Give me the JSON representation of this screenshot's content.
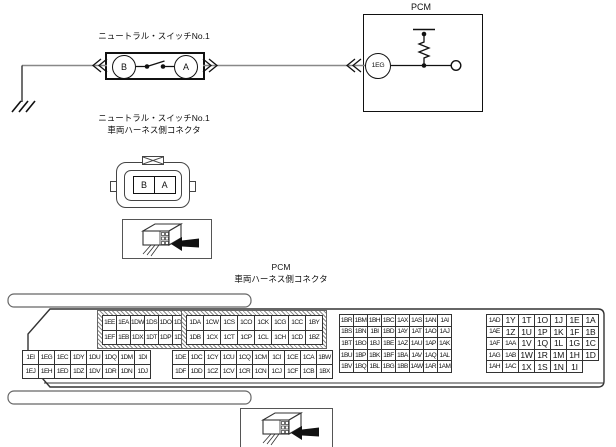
{
  "circuit": {
    "switch": {
      "label": "ニュートラル・スイッチNo.1",
      "terminal_left": "B",
      "terminal_right": "A"
    },
    "pcm": {
      "label": "PCM",
      "connector_pin": "1EG"
    }
  },
  "switch_connector": {
    "label_line1": "ニュートラル・スイッチNo.1",
    "label_line2": "車両ハーネス側コネクタ",
    "terminal_left": "B",
    "terminal_right": "A"
  },
  "pcm_connector": {
    "label_line1": "PCM",
    "label_line2": "車両ハーネス側コネクタ",
    "blocks": {
      "top_left": {
        "rows": [
          [
            "1EE",
            "1EA",
            "1DW",
            "1DS",
            "1DO",
            "1DK",
            "1DG"
          ],
          [
            "1EF",
            "1EB",
            "1DX",
            "1DT",
            "1DP",
            "1DL",
            "1DH"
          ]
        ]
      },
      "top_mid": {
        "rows": [
          [
            "1DA",
            "1CW",
            "1CS",
            "1CO",
            "1CK",
            "1CG",
            "1CC",
            "1BY"
          ],
          [
            "1DB",
            "1CX",
            "1CT",
            "1CP",
            "1CL",
            "1CH",
            "1CD",
            "1BZ"
          ]
        ]
      },
      "bottom_left": {
        "rows": [
          [
            "1EI",
            "1EG",
            "1EC",
            "1DY",
            "1DU",
            "1DQ",
            "1DM",
            "1DI"
          ],
          [
            "1EJ",
            "1EH",
            "1ED",
            "1DZ",
            "1DV",
            "1DR",
            "1DN",
            "1DJ"
          ]
        ]
      },
      "bottom_mid": {
        "rows": [
          [
            "1DE",
            "1DC",
            "1CY",
            "1CU",
            "1CQ",
            "1CM",
            "1CI",
            "1CE",
            "1CA",
            "1BW"
          ],
          [
            "1DF",
            "1DD",
            "1CZ",
            "1CV",
            "1CR",
            "1CN",
            "1CJ",
            "1CF",
            "1CB",
            "1BX"
          ]
        ]
      },
      "right_a": {
        "rows": [
          [
            "1BR",
            "1BM",
            "1BH",
            "1BC",
            "1AX",
            "1AS",
            "1AN",
            "1AI"
          ],
          [
            "1BS",
            "1BN",
            "1BI",
            "1BD",
            "1AY",
            "1AT",
            "1AO",
            "1AJ"
          ],
          [
            "1BT",
            "1BO",
            "1BJ",
            "1BE",
            "1AZ",
            "1AU",
            "1AP",
            "1AK"
          ],
          [
            "1BU",
            "1BP",
            "1BK",
            "1BF",
            "1BA",
            "1AV",
            "1AQ",
            "1AL"
          ],
          [
            "1BV",
            "1BQ",
            "1BL",
            "1BG",
            "1BB",
            "1AW",
            "1AR",
            "1AM"
          ]
        ]
      },
      "right_b": {
        "rows": [
          [
            "1AD",
            "1Y",
            "1T",
            "1O",
            "1J",
            "1E",
            "1A"
          ],
          [
            "1AE",
            "1Z",
            "1U",
            "1P",
            "1K",
            "1F",
            "1B"
          ],
          [
            "1AF",
            "1AA",
            "1V",
            "1Q",
            "1L",
            "1G",
            "1C"
          ],
          [
            "1AG",
            "1AB",
            "1W",
            "1R",
            "1M",
            "1H",
            "1D"
          ],
          [
            "1AH",
            "1AC",
            "1X",
            "1S",
            "1N",
            "1I"
          ]
        ]
      }
    }
  },
  "icons": {
    "connector_view": "connector-view-icon",
    "ground": "ground-icon"
  },
  "colors": {
    "line": "#111111",
    "wire": "#888888",
    "frame": "#333333"
  }
}
